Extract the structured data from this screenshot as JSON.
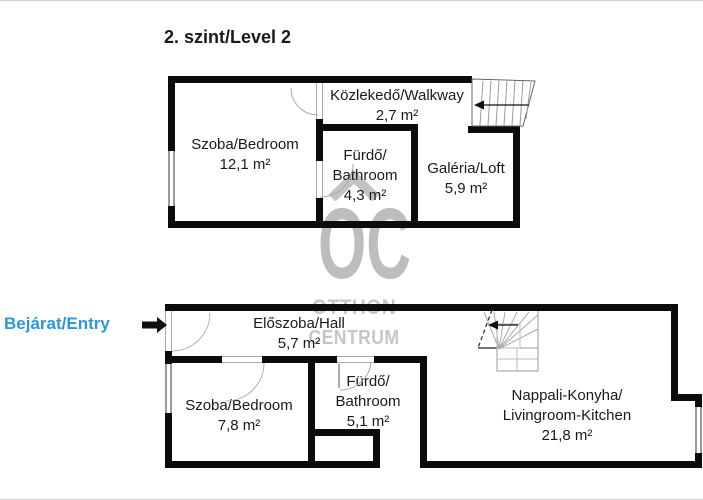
{
  "title": "2. szint/Level 2",
  "entry": {
    "label": "Bejárat/Entry"
  },
  "watermark": {
    "logo": "OC",
    "line1": "OTTHON",
    "line2": "CENTRUM"
  },
  "rooms": {
    "upper_bedroom": {
      "name": "Szoba/Bedroom",
      "area": "12,1 m²"
    },
    "upper_bathroom": {
      "name1": "Fürdő/",
      "name2": "Bathroom",
      "area": "4,3 m²"
    },
    "walkway": {
      "name": "Közlekedő/Walkway",
      "area": "2,7 m²"
    },
    "loft": {
      "name": "Galéria/Loft",
      "area": "5,9 m²"
    },
    "hall": {
      "name": "Előszoba/Hall",
      "area": "5,7 m²"
    },
    "lower_bedroom": {
      "name": "Szoba/Bedroom",
      "area": "7,8 m²"
    },
    "lower_bathroom": {
      "name1": "Fürdő/",
      "name2": "Bathroom",
      "area": "5,1 m²"
    },
    "living_kitchen": {
      "name1": "Nappali-Konyha/",
      "name2": "Livingroom-Kitchen",
      "area": "21,8 m²"
    }
  },
  "colors": {
    "accent_blue": "#2e97d4",
    "wall_black": "#0c0c0c",
    "watermark_gray": "#bdbdbd"
  }
}
